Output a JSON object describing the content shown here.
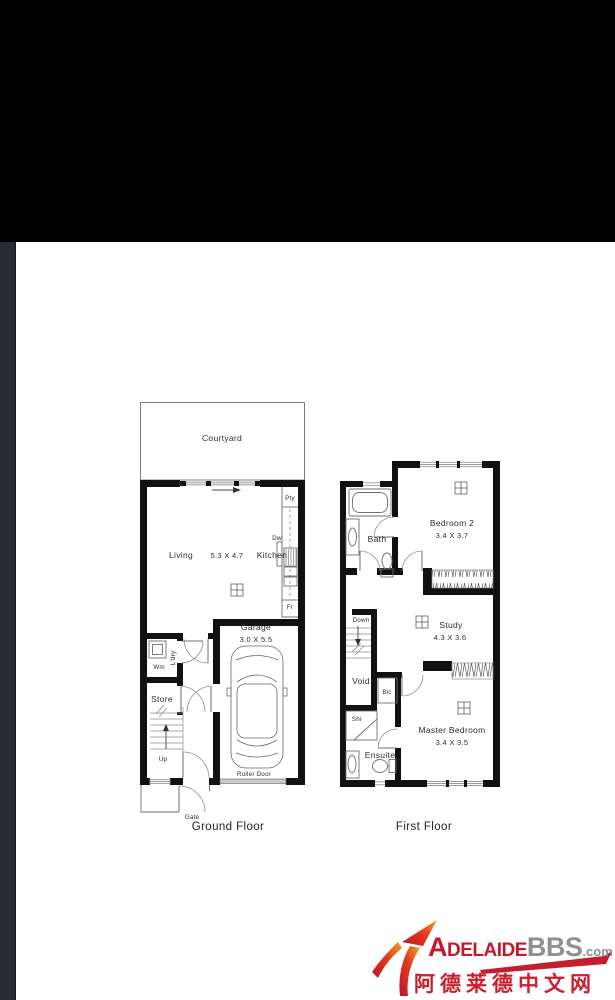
{
  "ground_floor": {
    "caption": "Ground Floor",
    "courtyard_label": "Courtyard",
    "living_label": "Living",
    "living_dims": "5.3 X 4.7",
    "kitchen_label": "Kitchen",
    "pantry_label": "Pty",
    "dishwasher_label": "Dw",
    "fridge_label": "Fr",
    "garage_label": "Garage",
    "garage_dims": "3.0 X 5.5",
    "roller_door_label": "Roller Door",
    "laundry_label": "L'dry",
    "washing_machine_label": "Wm",
    "store_label": "Store",
    "up_label": "Up",
    "gate_label": "Gate"
  },
  "first_floor": {
    "caption": "First Floor",
    "bath_label": "Bath",
    "bedroom2_label": "Bedroom 2",
    "bedroom2_dims": "3.4 X 3.7",
    "study_label": "Study",
    "study_dims": "4.3 X 3.6",
    "down_label": "Down",
    "void_label": "Void",
    "cupboard_label": "Bic",
    "shower_label": "Shr",
    "ensuite_label": "Ensuite",
    "master_label": "Master Bedroom",
    "master_dims": "3.4 X 3.5"
  },
  "icons": {
    "ceiling_fan": "crossed-square",
    "car": "car-top-view",
    "bathtub": "rounded-rect-tub",
    "toilet": "oval-with-cistern",
    "basin": "oval-in-rect",
    "stairs": "tread-lines-with-arrow",
    "door": "quarter-circle-arc",
    "arrow_swoosh": "red-orange-up-right-arrow"
  },
  "watermark": {
    "brand_adelaide": "Adelaide",
    "brand_bbs": "BBS",
    "brand_tld": ".com",
    "chinese_text": "阿德莱德中文网",
    "red": "#c4182f",
    "orange": "#f6a21f",
    "gray": "#8e9092"
  }
}
